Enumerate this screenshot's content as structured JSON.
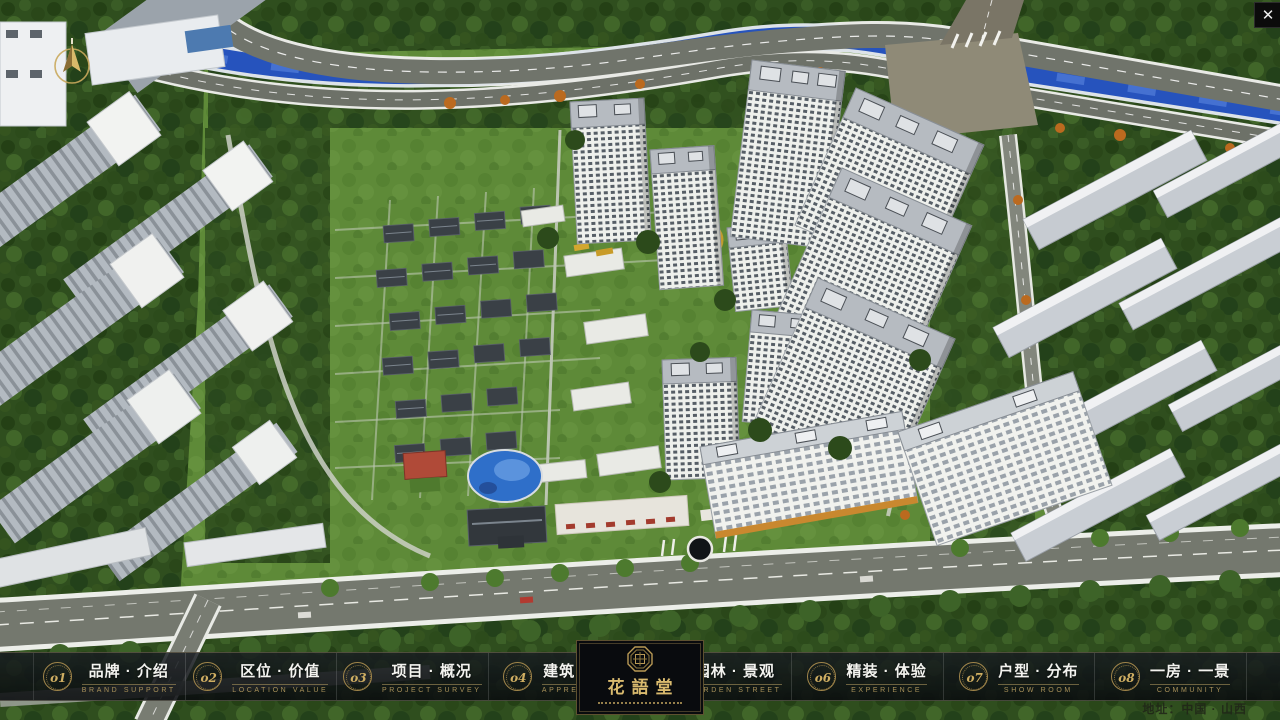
{
  "window": {
    "close_label": "✕"
  },
  "nav": {
    "items": [
      {
        "num": "o1",
        "label": "品牌 · 介绍",
        "sub": "BRAND SUPPORT"
      },
      {
        "num": "o2",
        "label": "区位 · 价值",
        "sub": "LOCATION VALUE"
      },
      {
        "num": "o3",
        "label": "项目 · 概况",
        "sub": "PROJECT SURVEY"
      },
      {
        "num": "o4",
        "label": "建筑 · 鉴赏",
        "sub": "APPRECIATION"
      },
      {
        "num": "o5",
        "label": "园林 · 景观",
        "sub": "GARDEN STREET"
      },
      {
        "num": "o6",
        "label": "精装 · 体验",
        "sub": "EXPERIENCE"
      },
      {
        "num": "o7",
        "label": "户型 · 分布",
        "sub": "SHOW ROOM"
      },
      {
        "num": "o8",
        "label": "一房 · 一景",
        "sub": "COMMUNITY"
      }
    ]
  },
  "logo": {
    "name": "花語堂"
  },
  "footer": {
    "address": "地址：中国 · 山西"
  },
  "scene": {
    "water_color": "#2653bd",
    "tree_color": "#2f4e1e",
    "road_color": "#70746b",
    "accent_gold": "#c9a85c"
  }
}
